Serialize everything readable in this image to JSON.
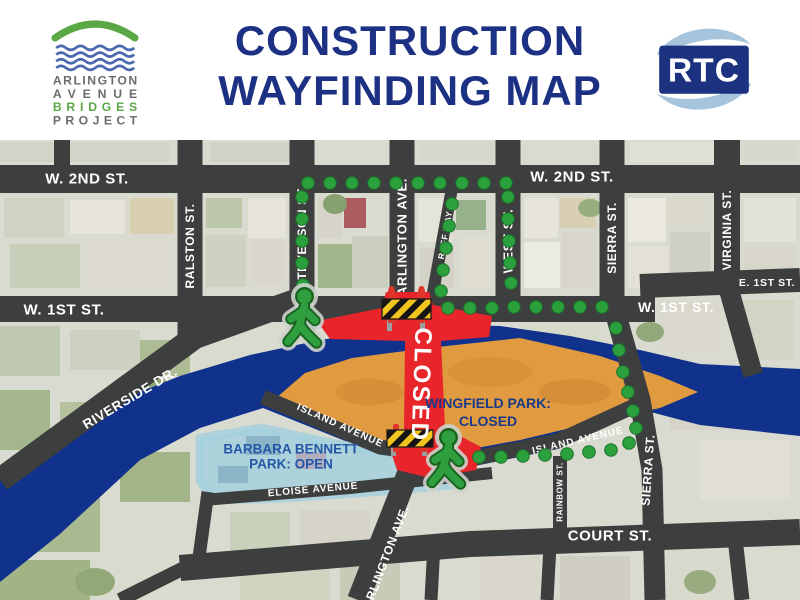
{
  "header": {
    "logo": {
      "line1": "ARLINGTON",
      "line2": "AVENUE",
      "line3": "BRIDGES",
      "line4": "PROJECT"
    },
    "title_line1": "CONSTRUCTION",
    "title_line2": "WAYFINDING MAP",
    "rtc_label": "RTC"
  },
  "map": {
    "labels": {
      "w2nd_a": "W. 2ND ST.",
      "w2nd_b": "W. 2ND ST.",
      "w1st_a": "W. 1ST ST.",
      "w1st_b": "W. 1ST ST.",
      "e1st": "E. 1ST ST.",
      "court": "COURT ST.",
      "ralston": "RALSTON ST.",
      "stevenson": "STEVENSON ST.",
      "arlington_top": "ARLINGTON AVE.",
      "arlington_low": "ARLINGTON AVE.",
      "roff": "ROFF WAY",
      "west": "WEST ST.",
      "sierra_top": "SIERRA ST.",
      "sierra_low": "SIERRA ST.",
      "virginia": "VIRGINIA ST.",
      "rainbow": "RAINBOW ST.",
      "riverside": "RIVERSIDE DR.",
      "island_a": "ISLAND AVENUE",
      "island_b": "ISLAND AVENUE",
      "eloise": "ELOISE AVENUE"
    },
    "annotations": {
      "closed_banner": "CLOSED",
      "wingfield_line1": "WINGFIELD PARK:",
      "wingfield_line2": "CLOSED",
      "barbara_line1": "BARBARA BENNETT",
      "barbara_line2": "PARK: OPEN"
    },
    "colors": {
      "title_navy": "#1d3184",
      "street_gray": "#3d3f3e",
      "closed_red": "#e8252a",
      "detour_green": "#2ca03c",
      "river_blue": "#10318c",
      "wingfield_orange": "#e09a40",
      "barbara_park_blue": "#a3d0de",
      "logo_green": "#5aa746",
      "logo_wave_blue": "#4b69ae",
      "rtc_swoosh_blue": "#a6c4dc"
    }
  }
}
